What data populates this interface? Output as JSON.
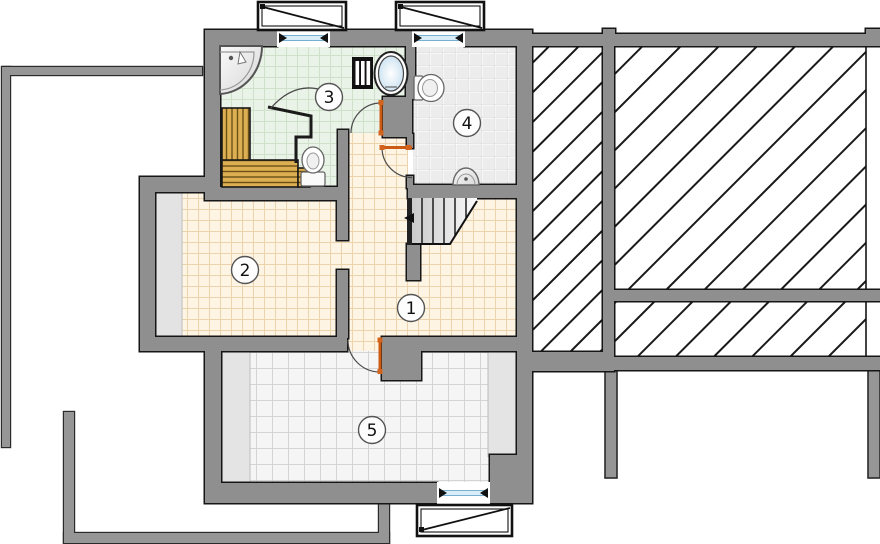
{
  "title": "attic-floor-plan",
  "rooms": [
    {
      "number": "1",
      "floor": "tile-beige"
    },
    {
      "number": "2",
      "floor": "tile-beige"
    },
    {
      "number": "3",
      "floor": "tile-green"
    },
    {
      "number": "4",
      "floor": "tile-gray"
    },
    {
      "number": "5",
      "floor": "tile-white"
    }
  ],
  "fixtures": [
    "corner-washbasin",
    "round-tub",
    "radiator",
    "toilet",
    "sauna-benches",
    "washbasin",
    "staircase"
  ],
  "colors": {
    "wall": "#8f8f8f",
    "wall_outline": "#161616",
    "lower_floor_outline": "#969696",
    "floor_beige": "#fdf4e3",
    "floor_beige_grid": "#ecd3ae",
    "floor_green": "#eaf3e7",
    "floor_green_grid": "#cfe0cb",
    "floor_gray": "#efefef",
    "floor_gray_grid": "#d8d8d8",
    "floor_white": "#f5f5f5",
    "floor_white_grid": "#d4d4d4",
    "door_leaf": "#cc5a12",
    "glazing": "#d8edf8",
    "glazing_edge": "#78aed0",
    "wood_bench": "#dcaf52",
    "wood_bench_line": "#6b5116",
    "hatch_line": "#1a1a1a"
  }
}
